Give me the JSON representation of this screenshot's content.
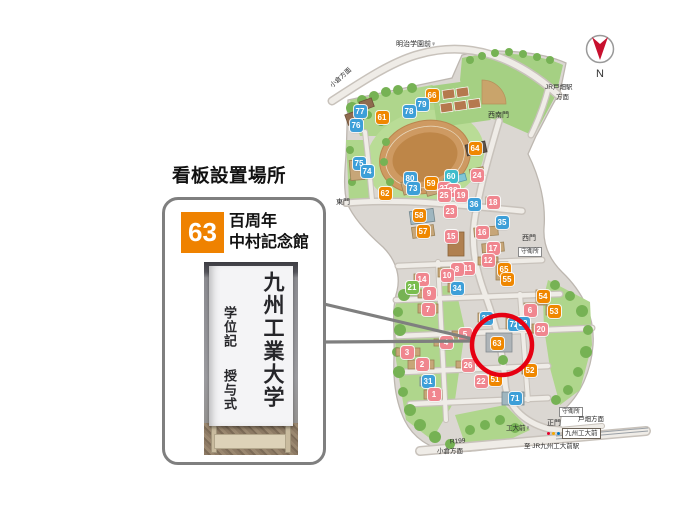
{
  "page": {
    "title": "看板設置場所"
  },
  "callout": {
    "badge_number": "63",
    "badge_color": "#EF8200",
    "building_name_line1": "百周年",
    "building_name_line2": "中村記念館",
    "photo": {
      "banner_main_text": "九州工業大学",
      "banner_sub_text_1": "学位記",
      "banner_sub_text_2": "授与式"
    }
  },
  "compass": {
    "label": "N",
    "arrow_color": "#C8102E"
  },
  "map": {
    "highlight_color": "#E60012",
    "callout_line_color": "#7F7F7F",
    "labels": {
      "bus_stop_top": "明治学園前♀",
      "dir_kokura_top": "小倉方面",
      "dir_jr_tobata_line1": "JR戸畑駅",
      "dir_jr_tobata_line2": "方面",
      "gate_southwest": "西南門",
      "gate_east": "東門",
      "gate_west": "西門",
      "guard_west": "守衛所",
      "guard_main": "守衛所",
      "gate_main": "正門",
      "dir_tobata": "戸畑方面",
      "bus_stop_kodaimae": "工大前♀",
      "station_box": "九州工大前",
      "to_jr_station": "至 JR九州工大前駅",
      "route_label": "R199",
      "dir_kokura_bottom": "小倉方面"
    },
    "marker_colors": {
      "blue": "#3D9FD8",
      "orange": "#EF8700",
      "pink": "#F0868F",
      "teal": "#3EBCCB",
      "green": "#7ABD4E"
    },
    "markers": [
      {
        "n": "66",
        "c": "orange",
        "x": 432,
        "y": 95
      },
      {
        "n": "79",
        "c": "blue",
        "x": 422,
        "y": 104
      },
      {
        "n": "78",
        "c": "blue",
        "x": 409,
        "y": 111
      },
      {
        "n": "77",
        "c": "blue",
        "x": 360,
        "y": 111
      },
      {
        "n": "61",
        "c": "orange",
        "x": 382,
        "y": 117
      },
      {
        "n": "76",
        "c": "blue",
        "x": 356,
        "y": 125
      },
      {
        "n": "64",
        "c": "orange",
        "x": 475,
        "y": 148
      },
      {
        "n": "75",
        "c": "blue",
        "x": 359,
        "y": 163
      },
      {
        "n": "74",
        "c": "blue",
        "x": 367,
        "y": 171
      },
      {
        "n": "80",
        "c": "blue",
        "x": 410,
        "y": 178
      },
      {
        "n": "59",
        "c": "orange",
        "x": 431,
        "y": 183
      },
      {
        "n": "60",
        "c": "teal",
        "x": 451,
        "y": 176
      },
      {
        "n": "24",
        "c": "pink",
        "x": 477,
        "y": 175
      },
      {
        "n": "73",
        "c": "blue",
        "x": 413,
        "y": 188
      },
      {
        "n": "62",
        "c": "orange",
        "x": 385,
        "y": 193
      },
      {
        "n": "27",
        "c": "pink",
        "x": 444,
        "y": 188
      },
      {
        "n": "28",
        "c": "pink",
        "x": 453,
        "y": 190
      },
      {
        "n": "25",
        "c": "pink",
        "x": 444,
        "y": 195
      },
      {
        "n": "19",
        "c": "pink",
        "x": 461,
        "y": 195
      },
      {
        "n": "36",
        "c": "blue",
        "x": 474,
        "y": 204
      },
      {
        "n": "18",
        "c": "pink",
        "x": 493,
        "y": 202
      },
      {
        "n": "23",
        "c": "pink",
        "x": 450,
        "y": 211
      },
      {
        "n": "58",
        "c": "orange",
        "x": 419,
        "y": 215
      },
      {
        "n": "35",
        "c": "blue",
        "x": 502,
        "y": 222
      },
      {
        "n": "57",
        "c": "orange",
        "x": 423,
        "y": 231
      },
      {
        "n": "15",
        "c": "pink",
        "x": 451,
        "y": 236
      },
      {
        "n": "16",
        "c": "pink",
        "x": 482,
        "y": 232
      },
      {
        "n": "17",
        "c": "pink",
        "x": 493,
        "y": 248
      },
      {
        "n": "12",
        "c": "pink",
        "x": 488,
        "y": 260
      },
      {
        "n": "11",
        "c": "pink",
        "x": 468,
        "y": 268
      },
      {
        "n": "8",
        "c": "pink",
        "x": 457,
        "y": 269
      },
      {
        "n": "10",
        "c": "pink",
        "x": 447,
        "y": 275
      },
      {
        "n": "65",
        "c": "orange",
        "x": 504,
        "y": 269
      },
      {
        "n": "55",
        "c": "orange",
        "x": 507,
        "y": 279
      },
      {
        "n": "14",
        "c": "pink",
        "x": 422,
        "y": 279
      },
      {
        "n": "21",
        "c": "green",
        "x": 412,
        "y": 287
      },
      {
        "n": "34",
        "c": "blue",
        "x": 457,
        "y": 288
      },
      {
        "n": "9",
        "c": "pink",
        "x": 429,
        "y": 293
      },
      {
        "n": "54",
        "c": "orange",
        "x": 543,
        "y": 296
      },
      {
        "n": "7",
        "c": "pink",
        "x": 428,
        "y": 309
      },
      {
        "n": "6",
        "c": "pink",
        "x": 530,
        "y": 310
      },
      {
        "n": "53",
        "c": "orange",
        "x": 554,
        "y": 311
      },
      {
        "n": "33",
        "c": "blue",
        "x": 486,
        "y": 318
      },
      {
        "n": "72",
        "c": "blue",
        "x": 514,
        "y": 324
      },
      {
        "n": "32",
        "c": "blue",
        "x": 523,
        "y": 323
      },
      {
        "n": "20",
        "c": "pink",
        "x": 541,
        "y": 329
      },
      {
        "n": "5",
        "c": "pink",
        "x": 465,
        "y": 334
      },
      {
        "n": "4",
        "c": "pink",
        "x": 446,
        "y": 342
      },
      {
        "n": "63",
        "c": "orange",
        "x": 497,
        "y": 343
      },
      {
        "n": "3",
        "c": "pink",
        "x": 407,
        "y": 352
      },
      {
        "n": "2",
        "c": "pink",
        "x": 422,
        "y": 364
      },
      {
        "n": "26",
        "c": "pink",
        "x": 468,
        "y": 365
      },
      {
        "n": "52",
        "c": "orange",
        "x": 530,
        "y": 370
      },
      {
        "n": "51",
        "c": "orange",
        "x": 495,
        "y": 379
      },
      {
        "n": "31",
        "c": "blue",
        "x": 428,
        "y": 381
      },
      {
        "n": "22",
        "c": "pink",
        "x": 481,
        "y": 381
      },
      {
        "n": "1",
        "c": "pink",
        "x": 434,
        "y": 394
      },
      {
        "n": "71",
        "c": "blue",
        "x": 515,
        "y": 398
      }
    ]
  }
}
